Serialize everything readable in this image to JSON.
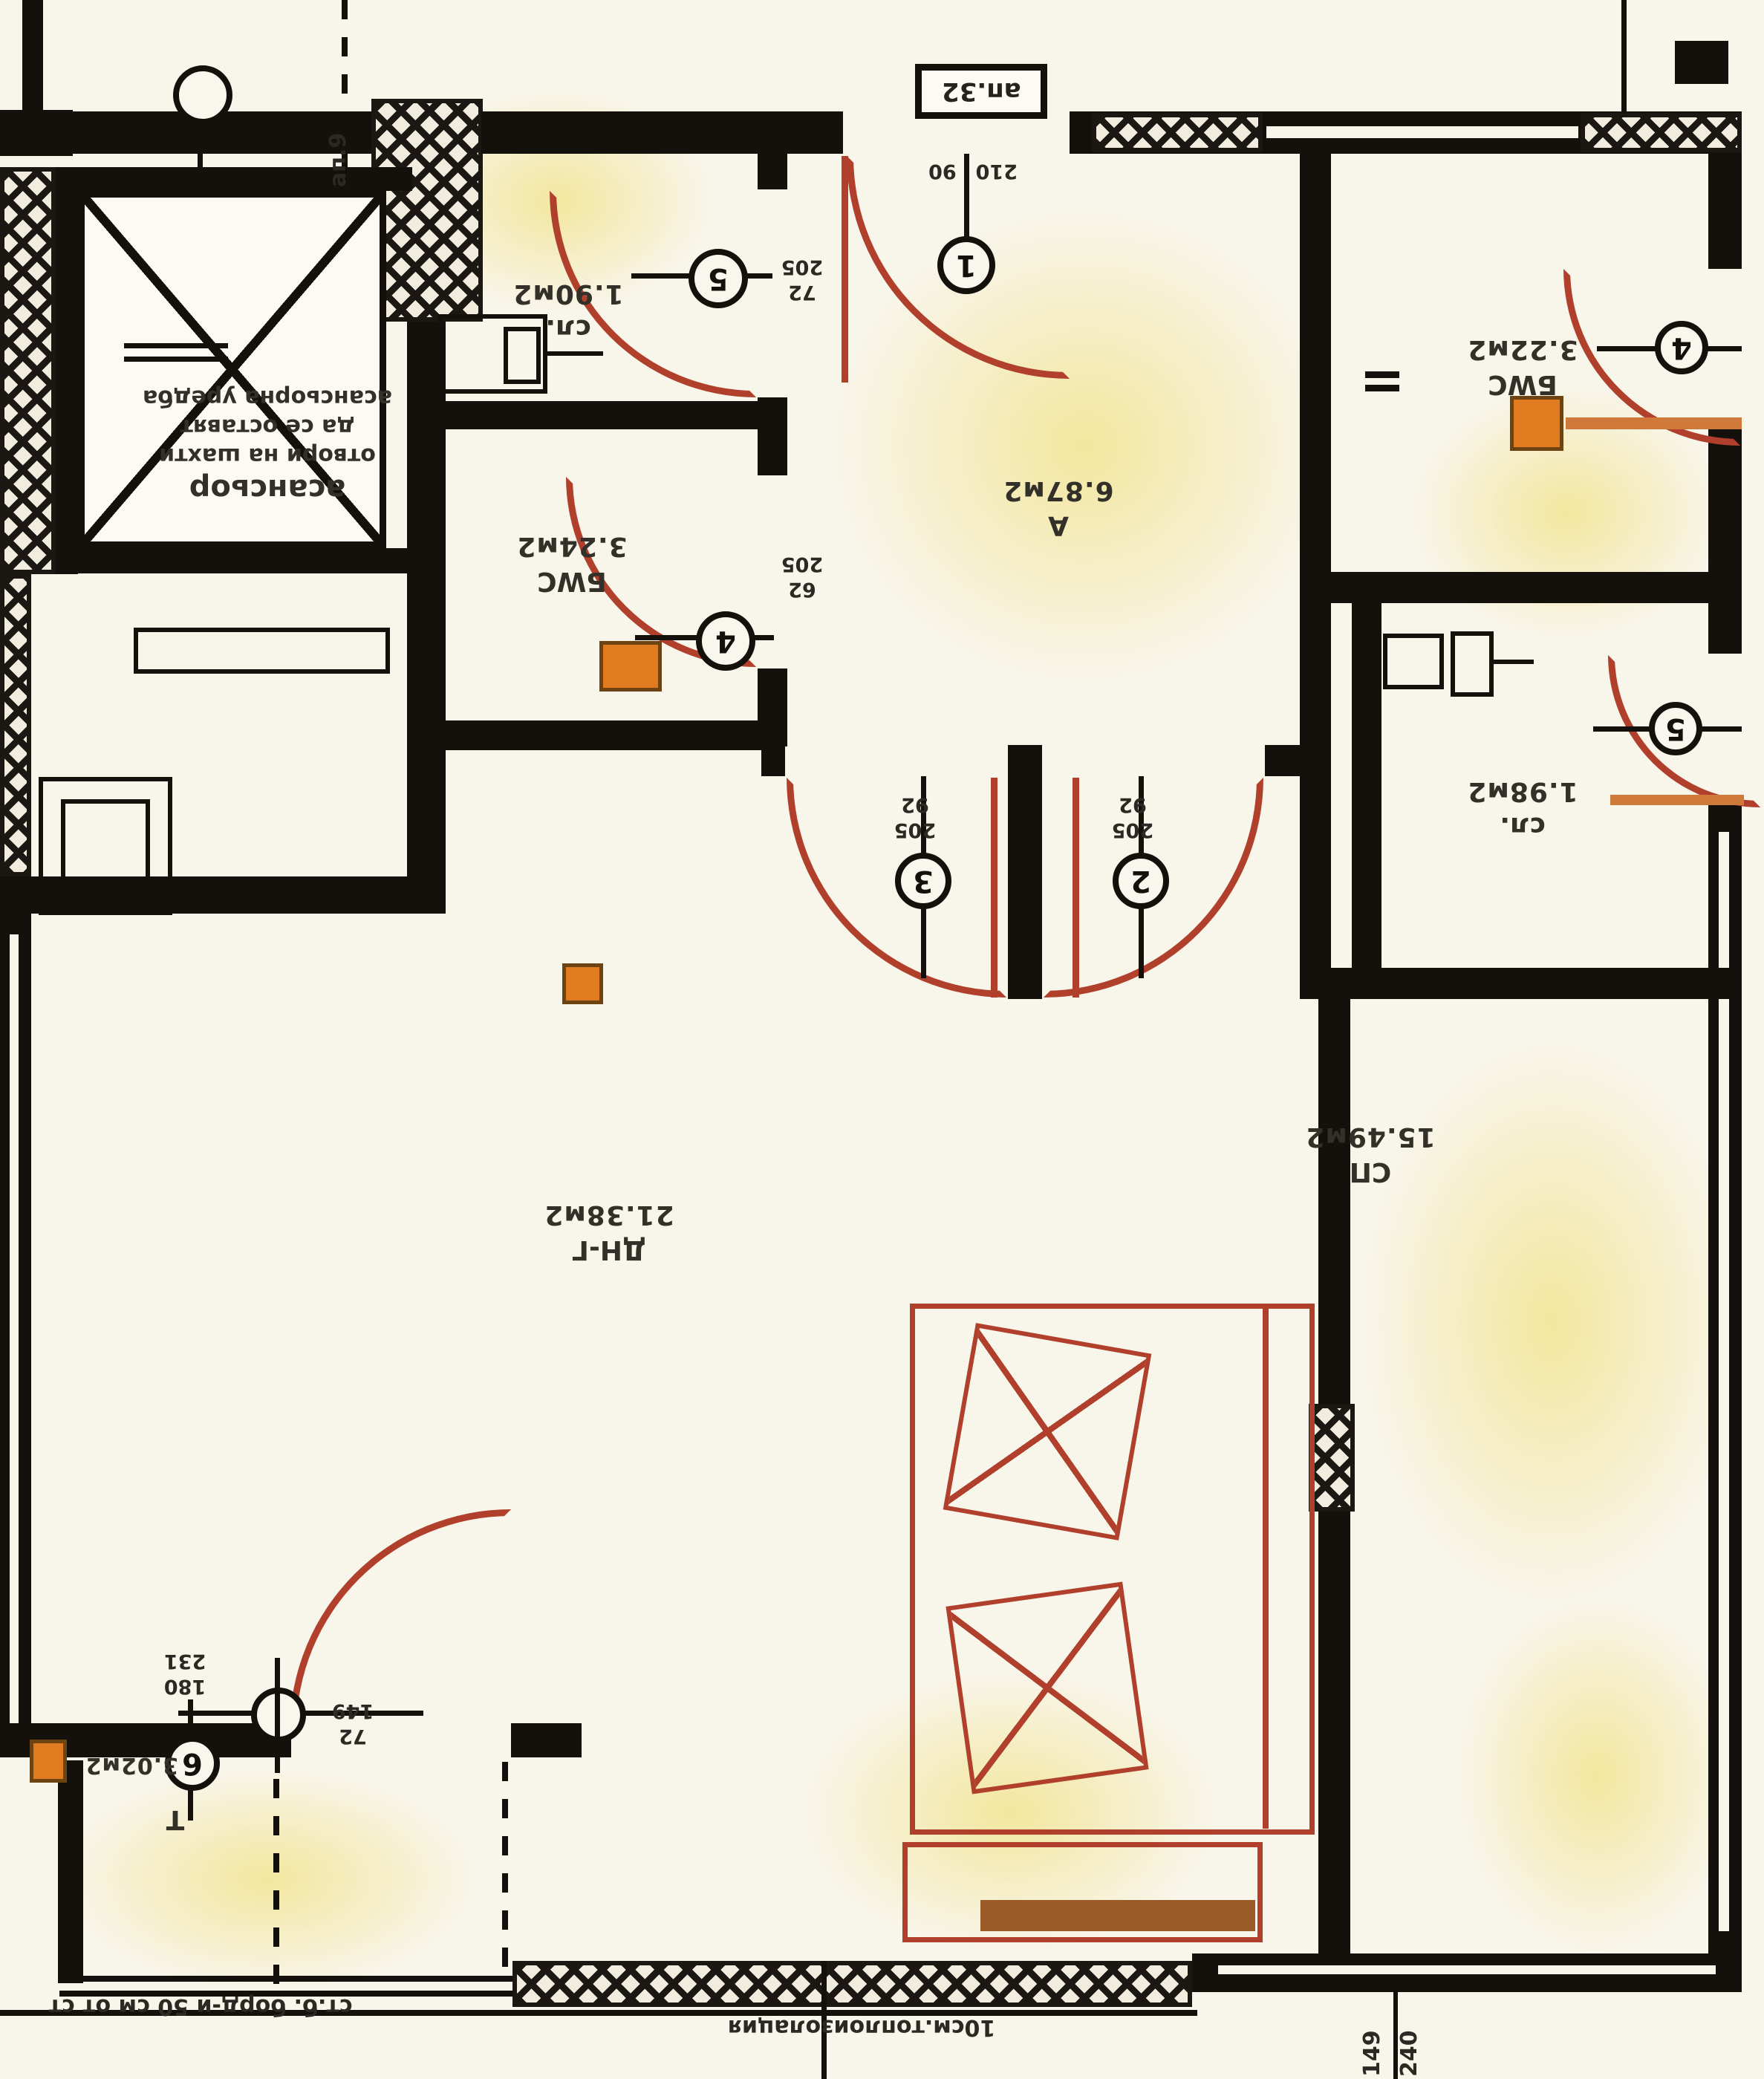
{
  "apartment_box": {
    "label": "ап.32"
  },
  "rooms": [
    {
      "key": "closet1",
      "name": "сл.",
      "area": "1.90м2"
    },
    {
      "key": "hall",
      "name": "А",
      "area": "6.87м2"
    },
    {
      "key": "wc_left",
      "name": "БWC",
      "area": "3.24м2"
    },
    {
      "key": "wc_right",
      "name": "БWC",
      "area": "3.22м2"
    },
    {
      "key": "closet2",
      "name": "сл.",
      "area": "1.98м2"
    },
    {
      "key": "living",
      "name": "ДН-Г",
      "area": "21.38м2"
    },
    {
      "key": "bedroom",
      "name": "СП",
      "area": "15.49м2"
    },
    {
      "key": "terrace",
      "name": "Т",
      "area": "3.02м2"
    }
  ],
  "doors": {
    "d1": {
      "tag": "1",
      "dims": [
        "90",
        "210"
      ]
    },
    "d2": {
      "tag": "2",
      "dims": [
        "92",
        "205"
      ]
    },
    "d3": {
      "tag": "3",
      "dims": [
        "92",
        "205"
      ]
    },
    "d4_left": {
      "tag": "4",
      "dims": [
        "62",
        "205"
      ]
    },
    "d4_right": {
      "tag": "4"
    },
    "d5_left": {
      "tag": "5",
      "dims": [
        "72",
        "205"
      ]
    },
    "d5_right": {
      "tag": "5"
    },
    "d6": {
      "tag": "6",
      "dims": [
        "180",
        "231"
      ]
    }
  },
  "axis_dims": {
    "dims": [
      "149",
      "72"
    ]
  },
  "bottom_dims": {
    "v1": "240",
    "v2": "149"
  },
  "elevator": {
    "label": "асансьор",
    "note_lines": [
      "отвори на шахти",
      "да се оставят",
      "асансьорна уредба"
    ]
  },
  "notes": {
    "insulation": "10см.топлоизолация",
    "curb": "ст.б. борд-и 50 см от ст",
    "side_vertical": "ап.9"
  },
  "colors": {
    "wall": "#14110d",
    "door_red": "#b0402c",
    "shaft_orange": "#e07b1f",
    "paper": "#f8f5ea",
    "tint_yellow": "#f3e9a8"
  }
}
